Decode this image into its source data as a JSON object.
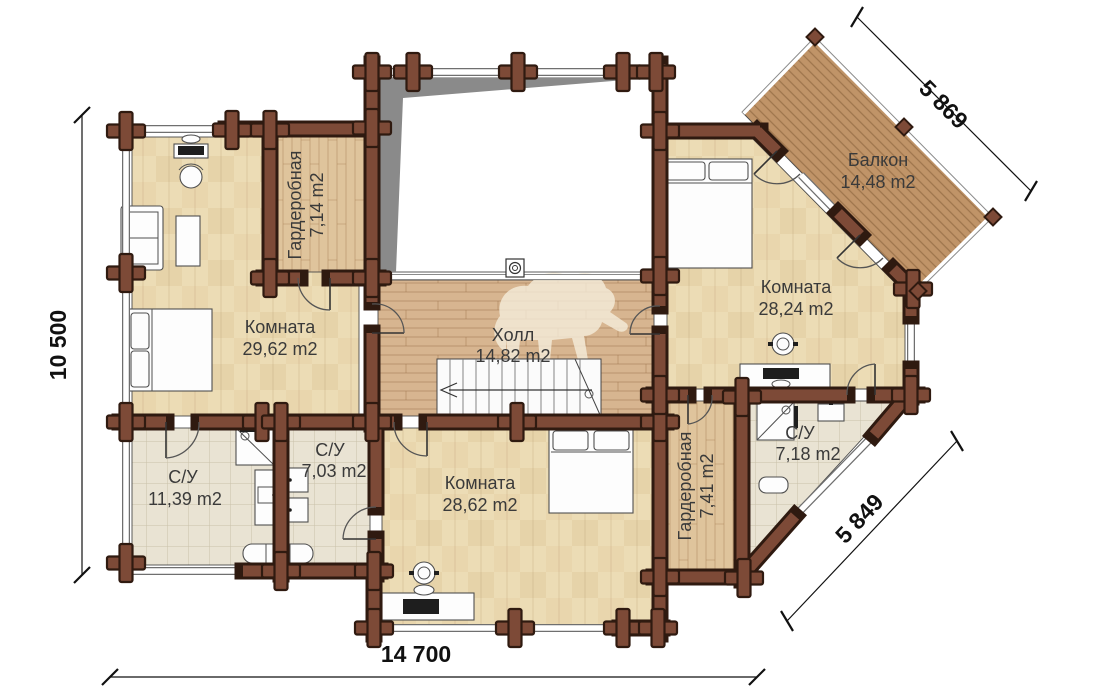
{
  "plan": {
    "rooms": [
      {
        "name": "Комната",
        "area": "29,62 m2"
      },
      {
        "name": "Гардеробная",
        "area": "7,14 m2"
      },
      {
        "name": "Холл",
        "area": "14,82 m2"
      },
      {
        "name": "Комната",
        "area": "28,24 m2"
      },
      {
        "name": "Балкон",
        "area": "14,48 m2"
      },
      {
        "name": "Комната",
        "area": "28,62 m2"
      },
      {
        "name": "С/У",
        "area": "11,39 m2"
      },
      {
        "name": "С/У",
        "area": "7,03 m2"
      },
      {
        "name": "Гардеробная",
        "area": "7,41 m2"
      },
      {
        "name": "С/У",
        "area": "7,18 m2"
      }
    ],
    "dimensions": {
      "left": "10 500",
      "bottom": "14 700",
      "balcony": "5 869",
      "corner": "5 849"
    },
    "colors": {
      "wall": "#7d4a37",
      "wall_outline": "#2f1a10",
      "floor_parquet": "#ecdcb5",
      "floor_hall": "#d7b590",
      "floor_tile": "#e9e3d3",
      "floor_balcony": "#c09468",
      "void_shadow": "#8a8a8a",
      "label": "#3a3a3a",
      "dimension": "#111111"
    }
  }
}
